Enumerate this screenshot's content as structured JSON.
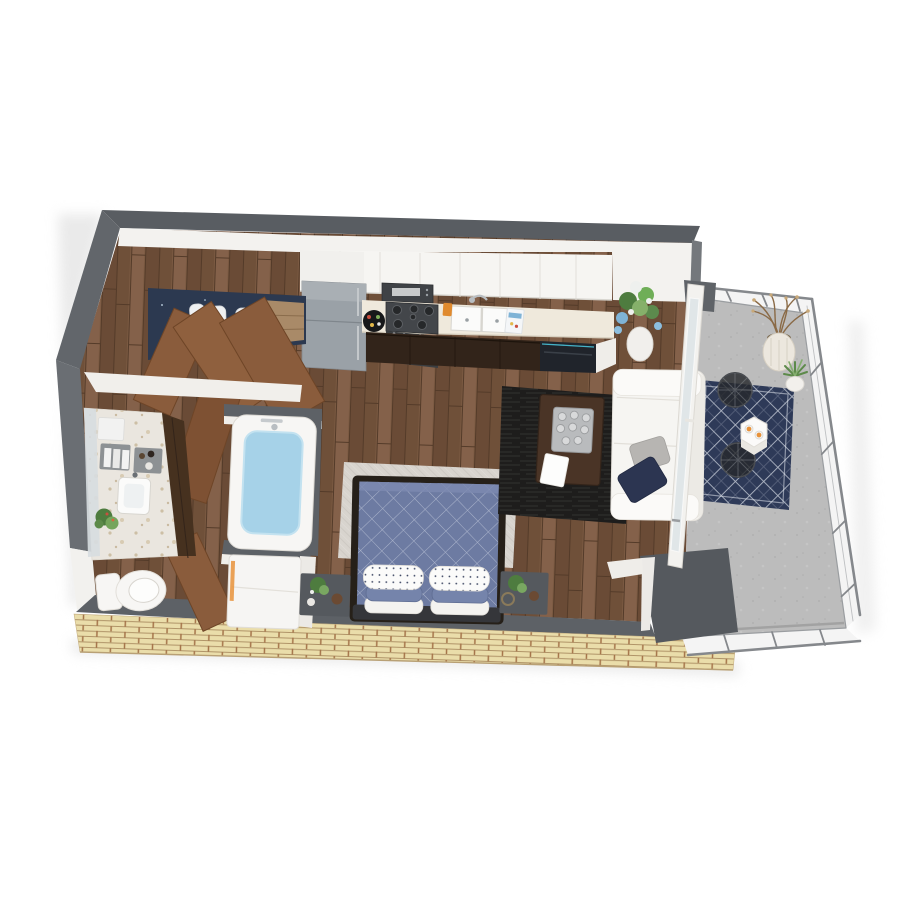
{
  "scene": {
    "kind": "3d-rendered-floor-plan",
    "view": "isometric top-down cutaway of a studio apartment with balcony",
    "background_color": "#ffffff"
  },
  "palette": {
    "exterior_wall_gray": "#5a5e63",
    "interior_wall_white": "#f2f1ee",
    "wood_floor_brown": "#7b5a42",
    "brick_exterior_tan": "#eaddaa",
    "brick_joint_red": "#a5744a",
    "door_wood_brown": "#8a5c3c",
    "kitchen_lower_cabinet_brown": "#32241a",
    "counter_cream": "#efe9dc",
    "appliance_gray": "#9aa1a7",
    "dishwasher_black": "#20242b",
    "bed_quilt_blue": "#6d7ba2",
    "bedroom_rug_offwhite": "#d8d4ce",
    "living_rug_charcoal": "#1e1d1c",
    "sofa_white": "#f6f5f2",
    "pillow_navy": "#2c3551",
    "tub_water_blue": "#a6d2e8",
    "balcony_floor_concrete": "#bcbcbc",
    "balcony_rug_navy": "#2e3a58",
    "railing_gray": "#85888c",
    "accent_orange": "#e8923a",
    "plant_green": "#5d8a4a",
    "closet_wall_navy": "#2c3950"
  },
  "rooms": [
    {
      "name": "kitchen",
      "items": [
        "refrigerator",
        "upper-cabinets",
        "microwave",
        "range-with-burners",
        "double-basin-sink",
        "countertop",
        "lower-cabinets",
        "dishwasher",
        "serving-tray",
        "cup",
        "cereal-box"
      ]
    },
    {
      "name": "entry-hall",
      "items": [
        "closet-with-hanging-clothes",
        "bifold-closet-doors",
        "entry-door",
        "hall-door"
      ]
    },
    {
      "name": "bathroom",
      "items": [
        "vanity-counter",
        "mirror",
        "towel-shelves",
        "vanity-sink",
        "potted-plant",
        "toilet",
        "bathtub-with-water",
        "washer-unit",
        "bathroom-door"
      ]
    },
    {
      "name": "sleeping-area",
      "items": [
        "area-rug",
        "bed-with-diamond-quilt",
        "pillow-stacks",
        "nightstand-left",
        "nightstand-right",
        "nightstand-plants"
      ]
    },
    {
      "name": "living-area",
      "items": [
        "charcoal-rug",
        "coffee-table",
        "cup-tray",
        "book",
        "sofa",
        "gray-throw-pillow",
        "navy-throw-pillow",
        "floor-vase-with-flowers"
      ]
    },
    {
      "name": "balcony",
      "items": [
        "concrete-floor",
        "metal-railing",
        "patterned-navy-rug",
        "hex-side-table",
        "orange-drinks",
        "two-mesh-chairs",
        "tall-planter-with-branches",
        "small-potted-plant",
        "sliding-glass-door"
      ]
    }
  ]
}
